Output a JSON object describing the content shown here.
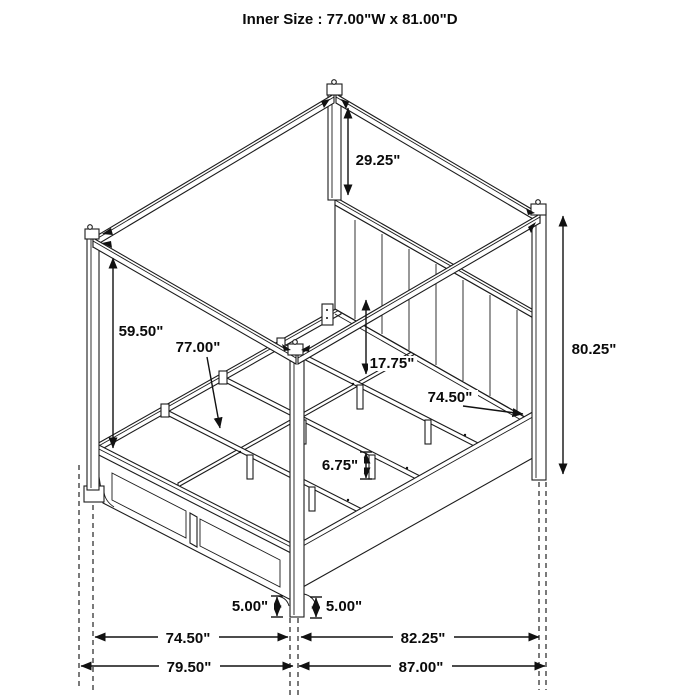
{
  "title": "Inner Size : 77.00\"W x 81.00\"D",
  "diagram_type": "canopy-bed-dimension-drawing",
  "dimensions": {
    "post_top_to_headboard": "29.25\"",
    "floor_to_canopy_frame": "59.50\"",
    "slat_length": "77.00\"",
    "rail_top_height": "17.75\"",
    "headboard_inner_width": "74.50\"",
    "overall_height": "80.25\"",
    "support_leg_height": "6.75\"",
    "footboard_floor_clearance": "5.00\"",
    "siderail_floor_clearance": "5.00\"",
    "footboard_inner_width": "74.50\"",
    "overall_width": "79.50\"",
    "siderail_length": "82.25\"",
    "overall_depth": "87.00\""
  }
}
